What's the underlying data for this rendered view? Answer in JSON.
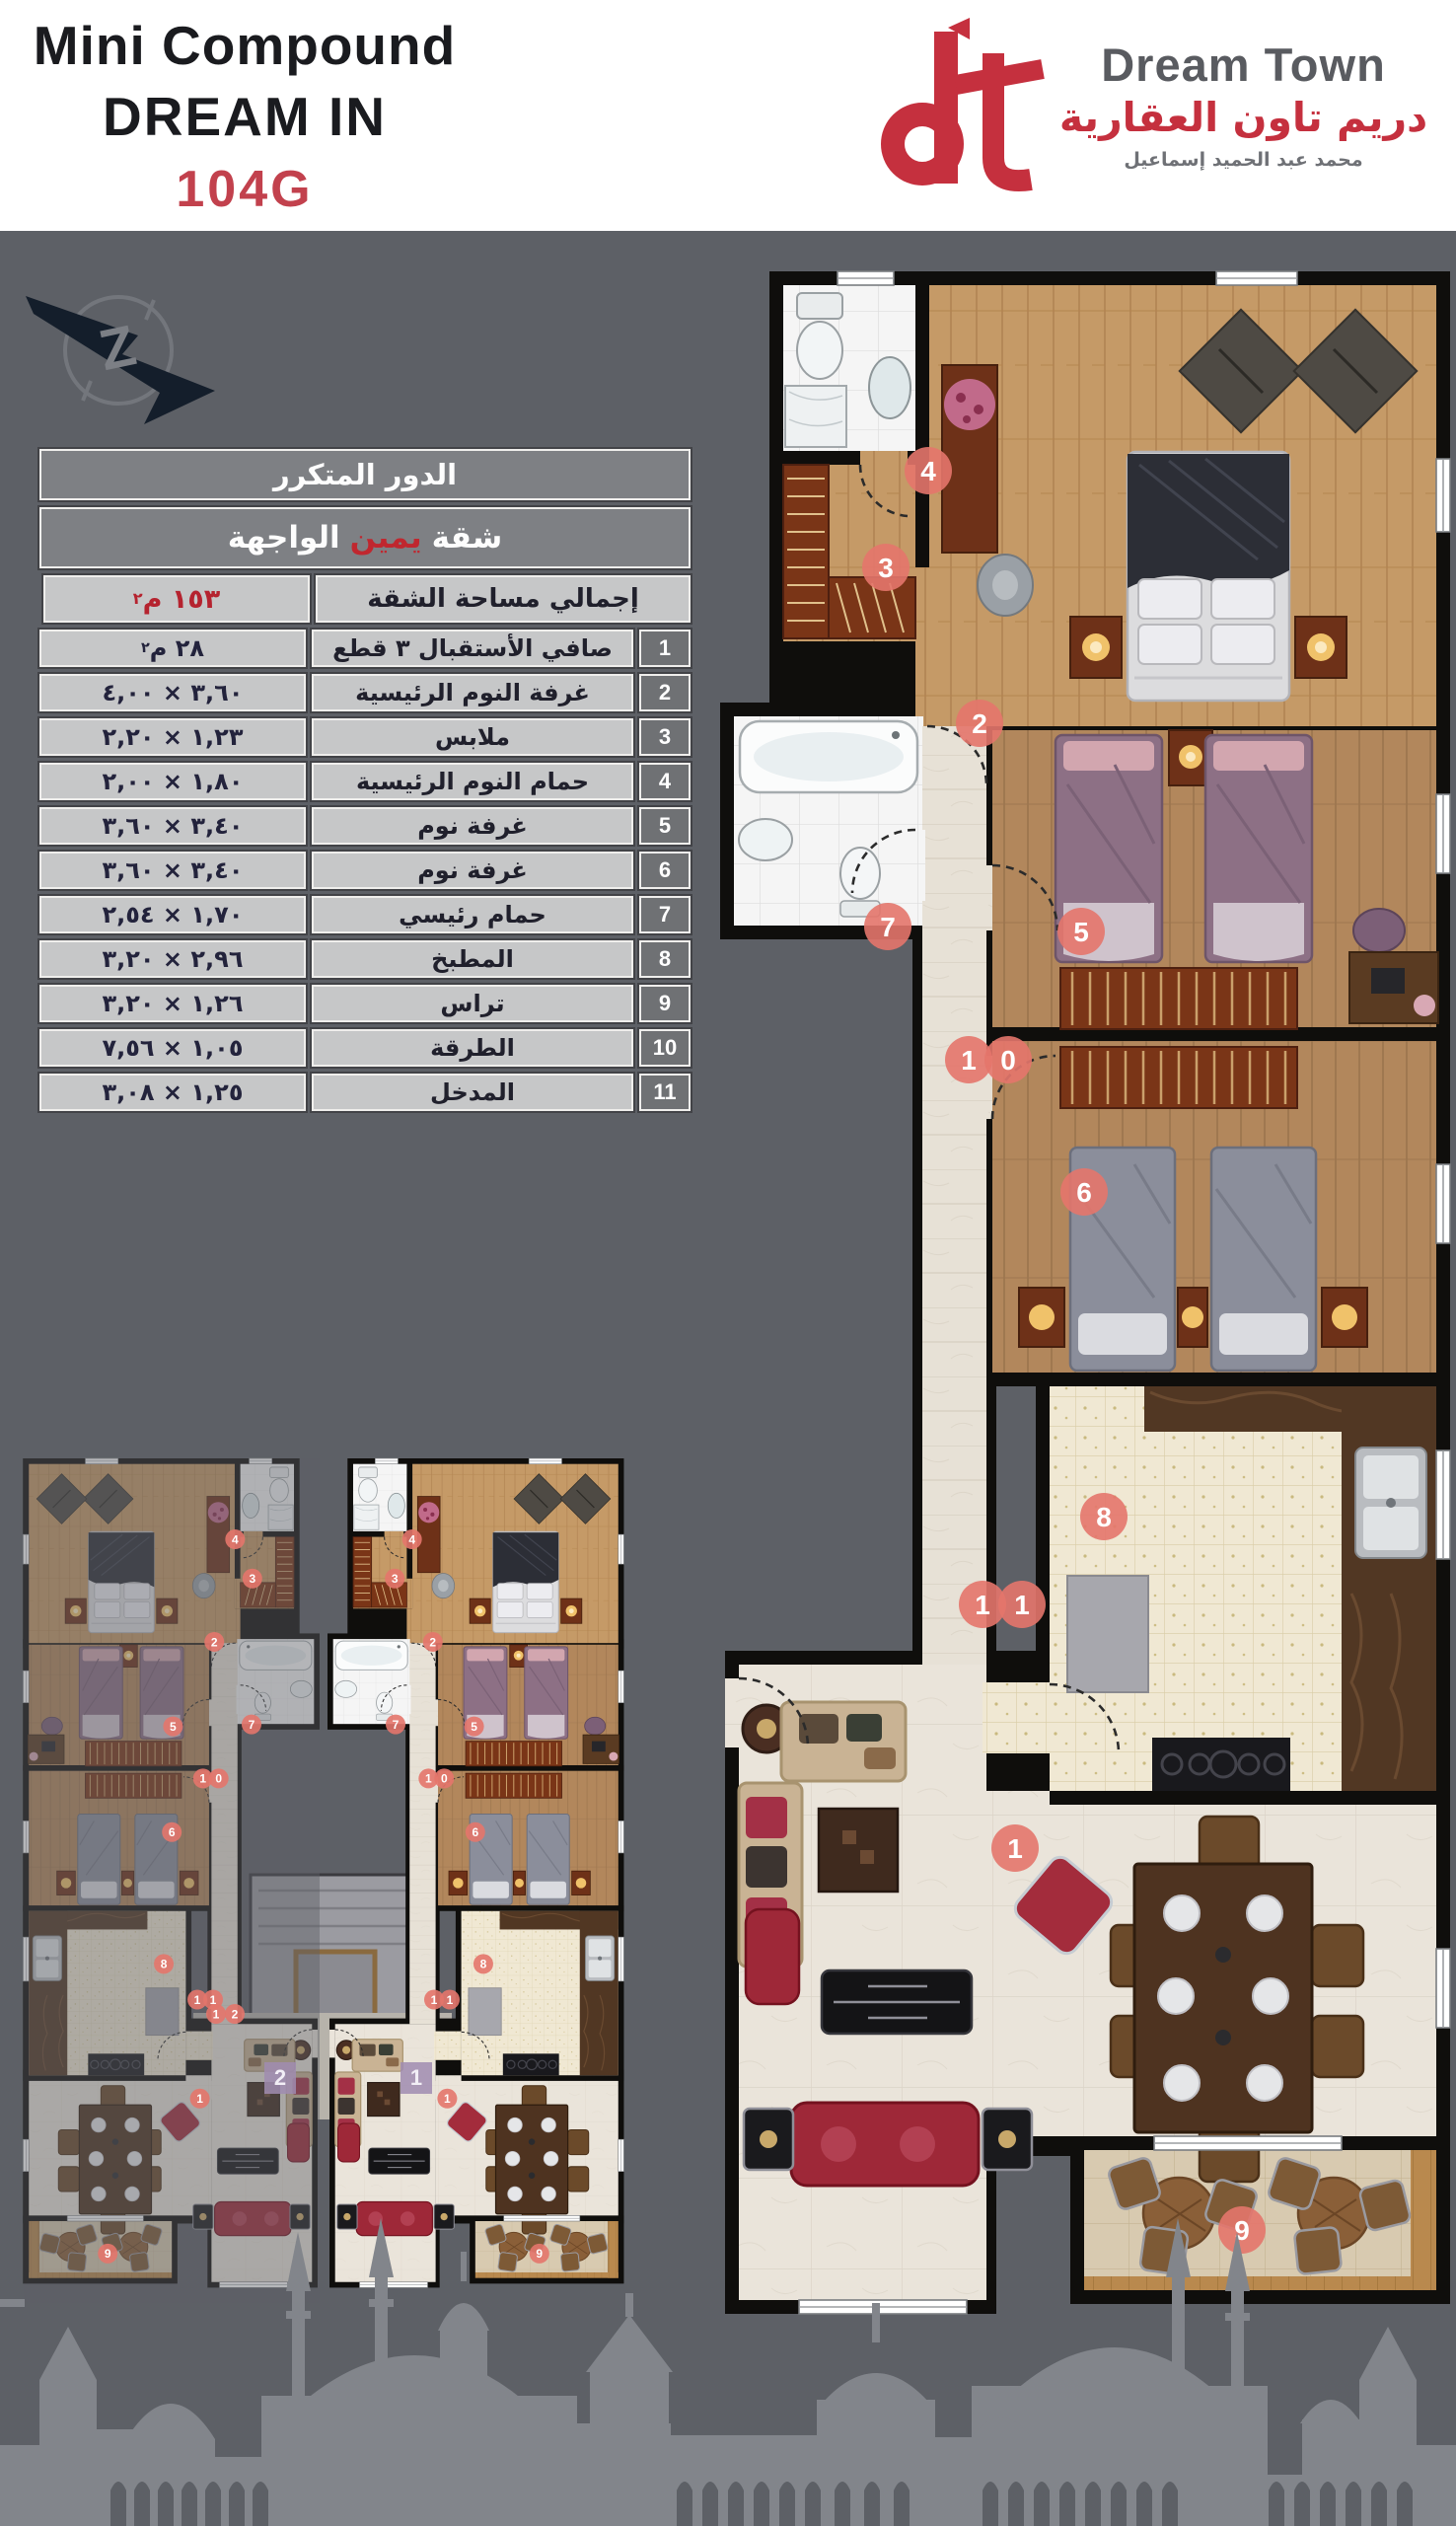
{
  "header": {
    "title_line1": "Mini Compound",
    "title_line2": "DREAM IN",
    "title_line3": "104G",
    "logo": {
      "name_en": "Dream Town",
      "name_ar": "دريم تاون العقارية",
      "owner_ar": "محمد عبد الحميد إسماعيل"
    }
  },
  "compass": {
    "letter": "Z"
  },
  "table": {
    "floor_title": "الدور المتكرر",
    "unit_prefix": "شقة",
    "unit_highlight": "يمين",
    "unit_suffix": "الواجهة",
    "total_label": "إجمالي مساحة الشقة",
    "total_value": "١٥٣ م",
    "total_sup": "٢",
    "rows": [
      {
        "num": "1",
        "name": "صافي الأستقبال ٣ قطع",
        "value": "٢٨ م",
        "sup": "٢"
      },
      {
        "num": "2",
        "name": "غرفة النوم الرئيسية",
        "value": "٣,٦٠ × ٤,٠٠",
        "sup": ""
      },
      {
        "num": "3",
        "name": "ملابس",
        "value": "١,٢٣ × ٢,٢٠",
        "sup": ""
      },
      {
        "num": "4",
        "name": "حمام النوم الرئيسية",
        "value": "١,٨٠ × ٢,٠٠",
        "sup": ""
      },
      {
        "num": "5",
        "name": "غرفة نوم",
        "value": "٣,٤٠ × ٣,٦٠",
        "sup": ""
      },
      {
        "num": "6",
        "name": "غرفة نوم",
        "value": "٣,٤٠ × ٣,٦٠",
        "sup": ""
      },
      {
        "num": "7",
        "name": "حمام رئيسي",
        "value": "١,٧٠ × ٢,٥٤",
        "sup": ""
      },
      {
        "num": "8",
        "name": "المطبخ",
        "value": "٢,٩٦ × ٣,٢٠",
        "sup": ""
      },
      {
        "num": "9",
        "name": "تراس",
        "value": "١,٢٦ × ٣,٢٠",
        "sup": ""
      },
      {
        "num": "10",
        "name": "الطرقة",
        "value": "١,٠٥ × ٧,٥٦",
        "sup": ""
      },
      {
        "num": "11",
        "name": "المدخل",
        "value": "١,٢٥ × ٣,٠٨",
        "sup": ""
      }
    ]
  },
  "plan": {
    "badges": [
      {
        "label": "1"
      },
      {
        "label": "2"
      },
      {
        "label": "3"
      },
      {
        "label": "4"
      },
      {
        "label": "5"
      },
      {
        "label": "6"
      },
      {
        "label": "7"
      },
      {
        "label": "8"
      },
      {
        "label": "9"
      },
      {
        "label": "10"
      },
      {
        "label": "11"
      }
    ]
  },
  "inset": {
    "unit_left_label": "2",
    "unit_right_label": "1",
    "corridor_badge": "12"
  },
  "colors": {
    "accent_red": "#c2414d",
    "brand_red": "#c5303e",
    "badge_salmon": "#e4756b",
    "background_gray": "#5d6066",
    "skyline_gray": "#82858b",
    "table_head_gray": "#7e8084",
    "table_cell_gray": "#c6c7c8"
  }
}
